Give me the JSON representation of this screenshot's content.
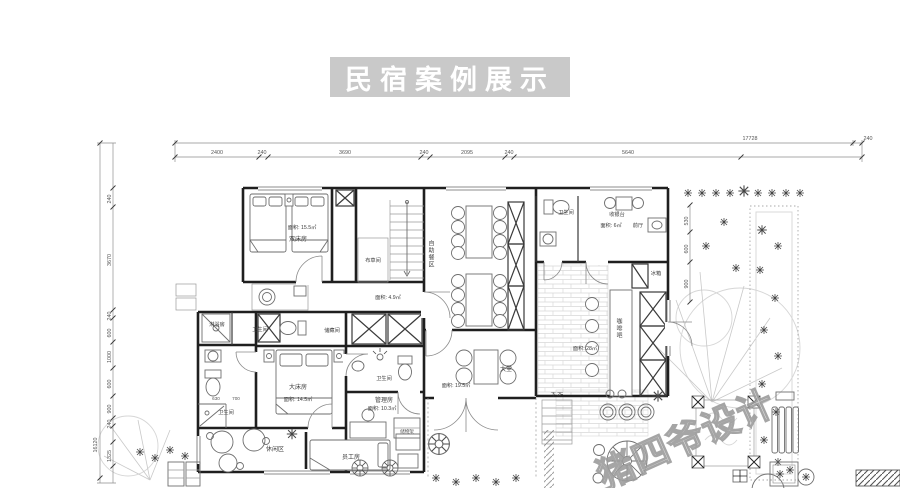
{
  "banner": {
    "title": "民宿案例展示",
    "bg": "#c9c9c9",
    "fg": "#ffffff"
  },
  "watermark": {
    "text": "猪四爷设计"
  },
  "dimensions": {
    "top": {
      "overall": "17728",
      "right": "240",
      "segments": [
        "2400",
        "240",
        "3690",
        "240",
        "2095",
        "240",
        "5640"
      ]
    },
    "left": {
      "overall": "16120",
      "segments": [
        "240",
        "3670",
        "240",
        "600",
        "1000",
        "600",
        "900",
        "240",
        "1325"
      ]
    },
    "right_side": {
      "segments": [
        "530",
        "600",
        "900"
      ]
    }
  },
  "rooms": {
    "twin": {
      "name": "双床房",
      "area": "面积: 15.5㎡"
    },
    "linen": {
      "name": "布草间"
    },
    "corridor": {
      "area": "面积: 4.9㎡"
    },
    "shower": {
      "name": "淋浴房"
    },
    "wc_strip": {
      "name": "卫生间"
    },
    "storage": {
      "name": "储藏间"
    },
    "master": {
      "name": "大床房",
      "area": "面积: 14.5㎡",
      "dims": [
        "630",
        "700"
      ]
    },
    "wc_master": {
      "name": "卫生间"
    },
    "wc_small": {
      "name": "卫生间"
    },
    "office": {
      "name": "管理房",
      "area": "面积: 10.3㎡",
      "shelf": "储物架"
    },
    "leisure": {
      "name": "休闲区"
    },
    "staff": {
      "name": "员工房"
    },
    "dining": {
      "name": "自助餐区"
    },
    "wc_top": {
      "name": "卫生间"
    },
    "hall": {
      "name": "前厅",
      "cashier": "收银台",
      "area": "面积: 6㎡"
    },
    "bar": {
      "name": "咖啡吧",
      "area": "面积: 28㎡",
      "fridge": "冰箱"
    },
    "lobby": {
      "name": "大堂",
      "area": "面积: 19.5㎡",
      "stair": "下 2F"
    }
  }
}
